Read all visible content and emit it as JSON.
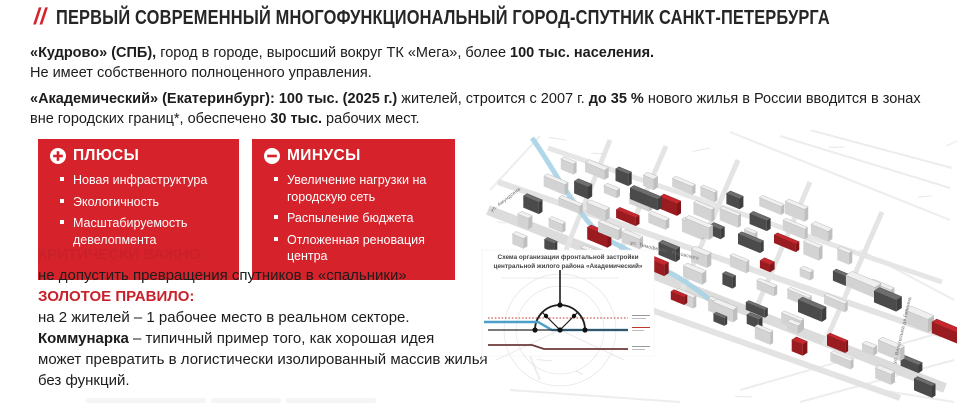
{
  "page": {
    "title_mark": "//",
    "title": "ПЕРВЫЙ СОВРЕМЕННЫЙ МНОГОФУНКЦИОНАЛЬНЫЙ ГОРОД-СПУТНИК САНКТ-ПЕТЕРБУРГА"
  },
  "colors": {
    "accent_red": "#d6232b",
    "heading_red": "#c9202a",
    "map_red_roof": "#c8262d",
    "map_dark_roof": "#6e6e6e",
    "river_blue": "#a6d3e6"
  },
  "icons": {
    "pluses": "plus-circle-icon",
    "minuses": "minus-circle-icon"
  },
  "paragraphs": {
    "kudrovo": {
      "bold1": "«Кудрово» (СПБ),",
      "text1": " город в городе, выросший вокруг ТК «Мега», более ",
      "bold2": "100 тыс. населения.",
      "line2": "Не имеет собственного полноценного управления."
    },
    "akademichesky": {
      "bold1": "«Академический» (Екатеринбург): 100 тыс. (2025 г.)",
      "text1": " жителей, строится с 2007 г.  ",
      "bold2": "до 35 %",
      "text2": " нового жилья в России вводится в зонах вне городских границ*, обеспечено ",
      "bold3": "30 тыс.",
      "text3": " рабочих мест."
    }
  },
  "pluses": {
    "title": "ПЛЮСЫ",
    "items": [
      "Новая инфраструктура",
      "Экологичность",
      "Масштабируемость девелопмента"
    ]
  },
  "minuses": {
    "title": "МИНУСЫ",
    "items": [
      "Увеличение нагрузки на городскую сеть",
      "Распыление бюджета",
      "Отложенная реновация центра"
    ]
  },
  "critical": {
    "heading": "КРИТИЧЕСКИ ВАЖНО:",
    "text": "не допустить превращения спутников в «спальники»"
  },
  "golden_rule": {
    "heading": "ЗОЛОТОЕ ПРАВИЛО:",
    "text": "на 2 жителей – 1 рабочее место в реальном секторе."
  },
  "kommunarka": {
    "bold": "Коммунарка",
    "line1_rest": " – типичный пример того, как хорошая идея",
    "line2": "может превратить в логистически изолированный массив жилья",
    "line3": "без функций."
  },
  "map": {
    "caption_line1": "Схема организации фронтальной застройки",
    "caption_line2": "центральной жилого района «Академический»",
    "labels": {
      "street_left": "ул. Амундсена",
      "street_center": "ул. Тимофеева - Ресовского",
      "street_right": "ул. Вильгельма де Геннина"
    }
  }
}
